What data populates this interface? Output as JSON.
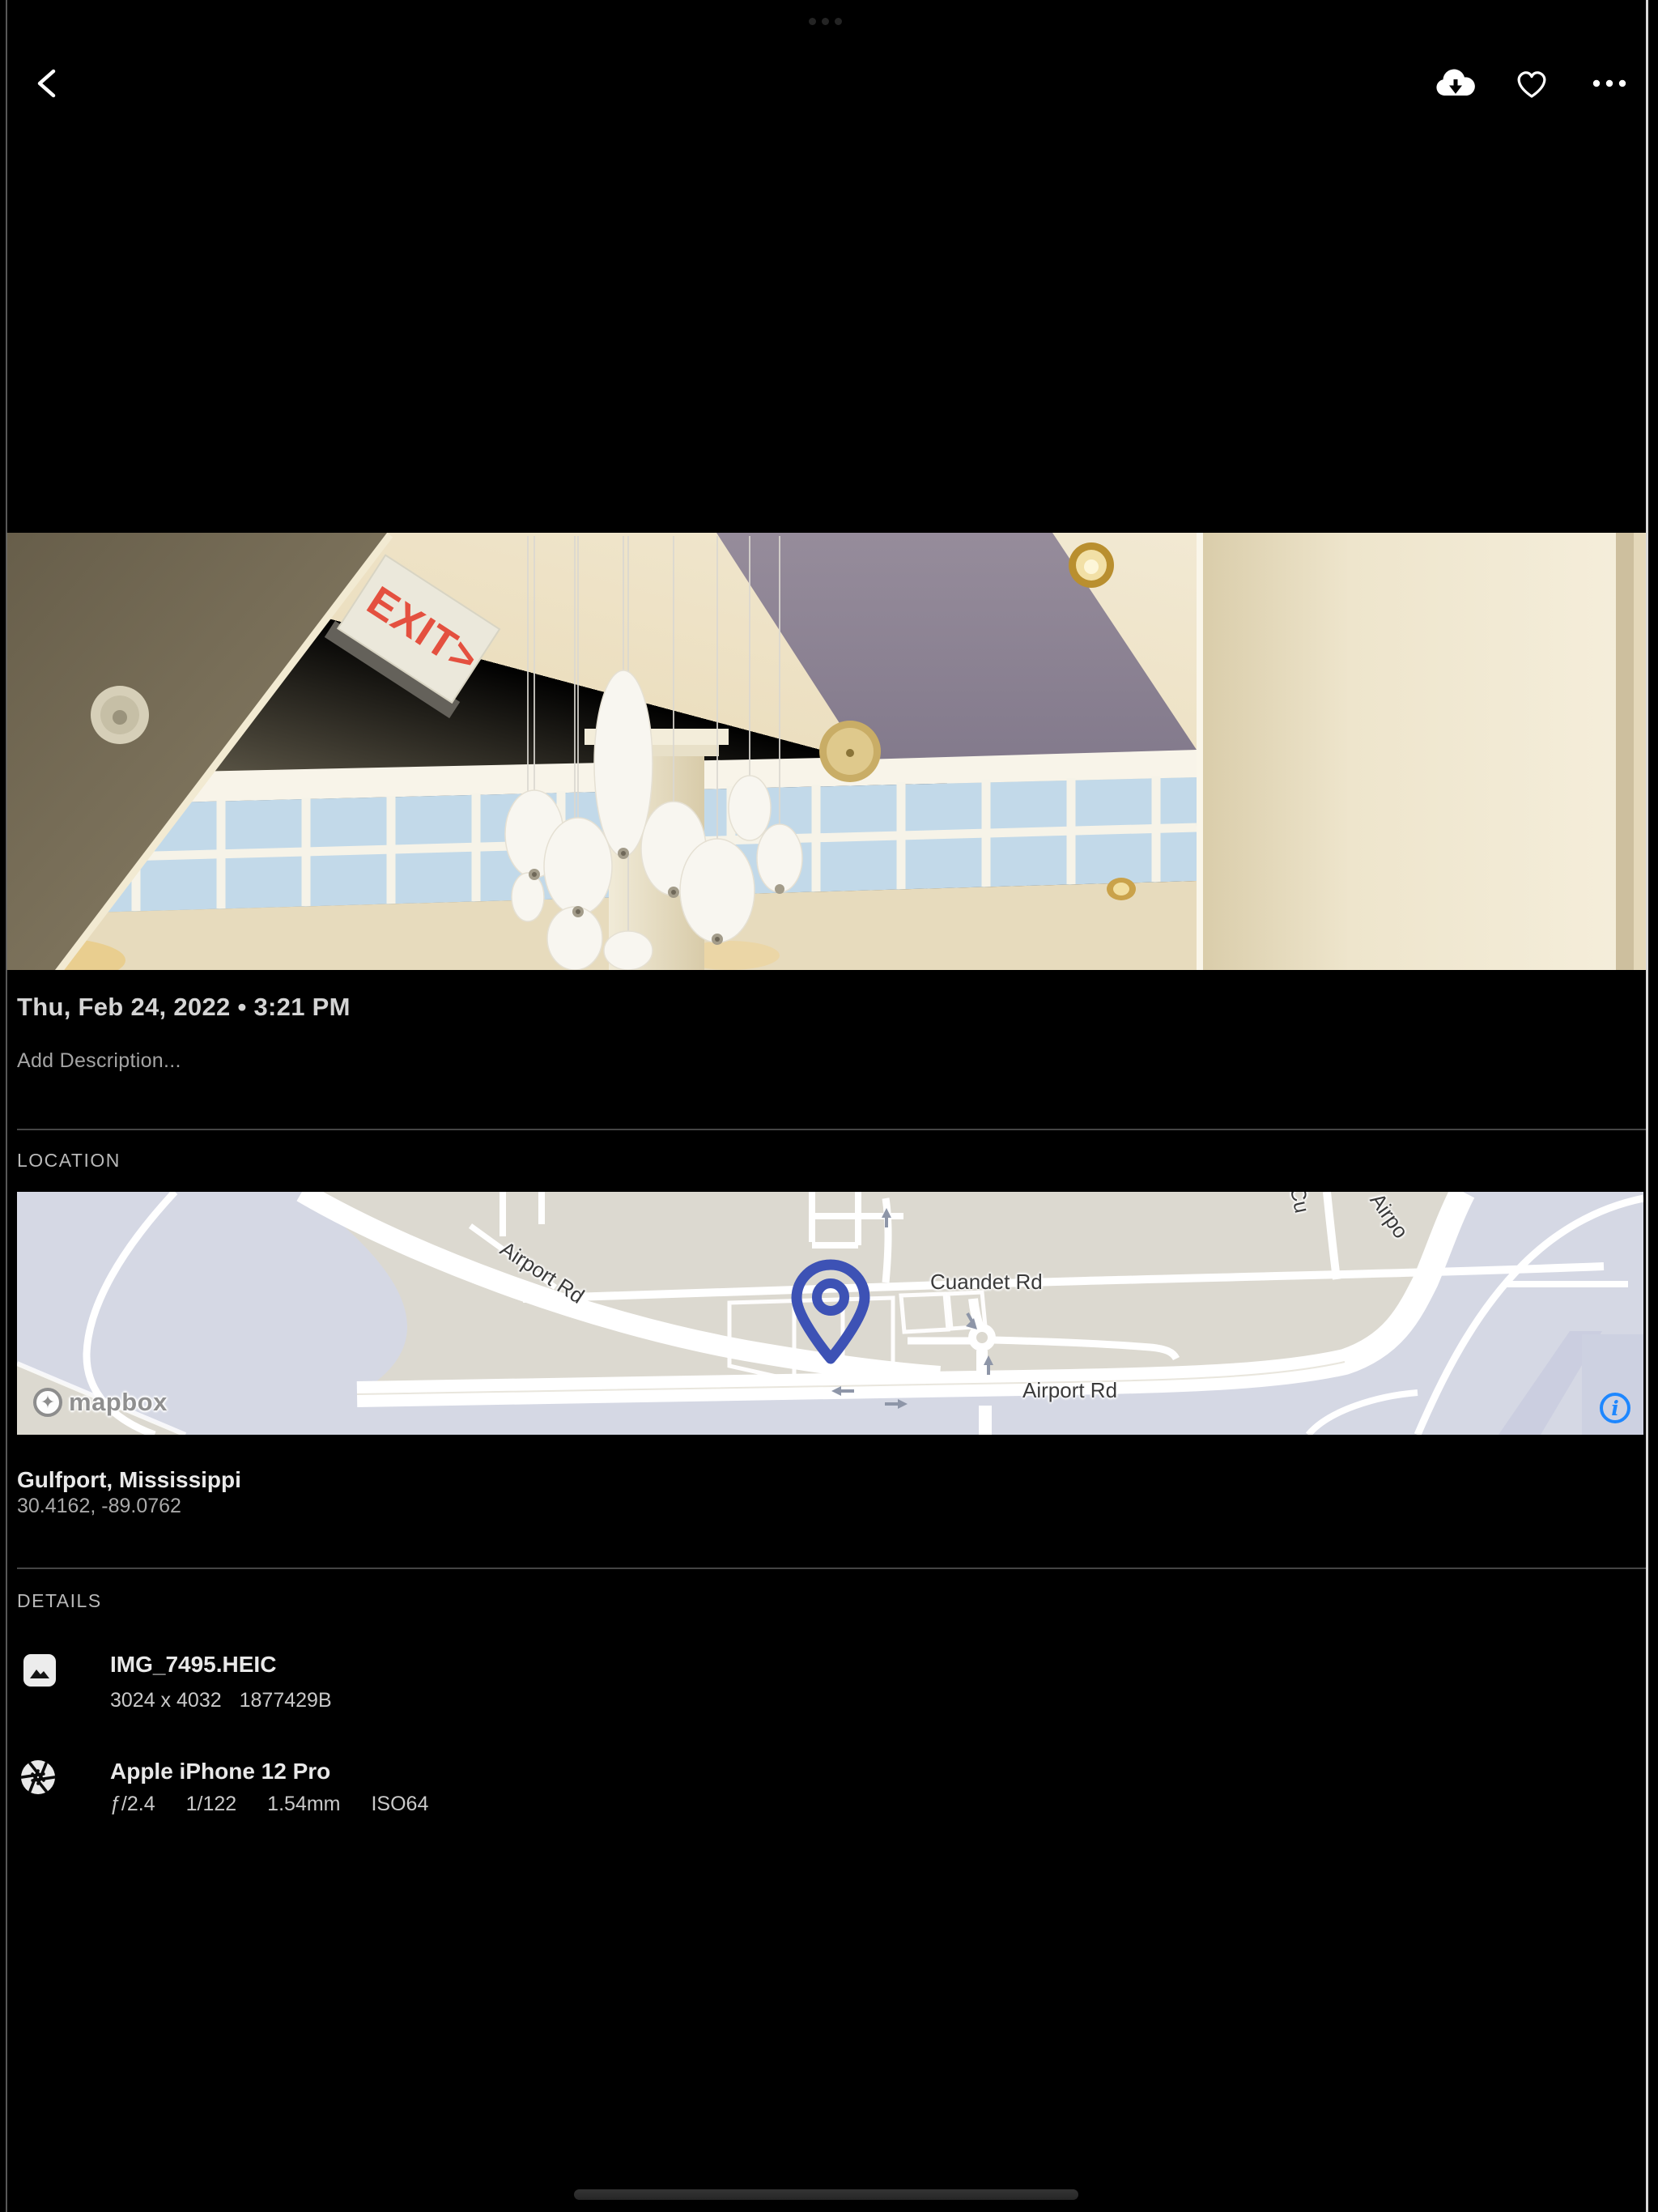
{
  "top_bar": {
    "back_icon": "chevron-left",
    "download_icon": "cloud-download",
    "favorite_icon": "heart-outline",
    "more_icon": "ellipsis"
  },
  "photo": {
    "exit_sign_text": "EXIT>"
  },
  "capture": {
    "date_line": "Thu, Feb 24, 2022 • 3:21 PM",
    "description_placeholder": "Add Description..."
  },
  "location": {
    "section_label": "LOCATION",
    "place": "Gulfport, Mississippi",
    "coordinates": "30.4162, -89.0762",
    "map": {
      "airport_rd_diagonal": "Airport Rd",
      "cuandet_rd": "Cuandet Rd",
      "airport_rd_horizontal": "Airport Rd",
      "clipped_label_1": "Cu",
      "clipped_label_2": "Airpo",
      "attribution": "mapbox",
      "info_glyph": "i"
    }
  },
  "details": {
    "section_label": "DETAILS",
    "file": {
      "name": "IMG_7495.HEIC",
      "dimensions": "3024 x 4032",
      "size": "1877429B"
    },
    "camera": {
      "name": "Apple iPhone 12 Pro",
      "aperture": "ƒ/2.4",
      "shutter": "1/122",
      "focal_length": "1.54mm",
      "iso": "ISO64"
    }
  },
  "colors": {
    "accent_blue": "#1e87ff",
    "pin_blue": "#3d52b5",
    "map_land": "#dcd9d0",
    "map_base": "#d5d8e4",
    "text_primary": "#e9e9e9",
    "text_secondary": "#a9a9a9"
  }
}
